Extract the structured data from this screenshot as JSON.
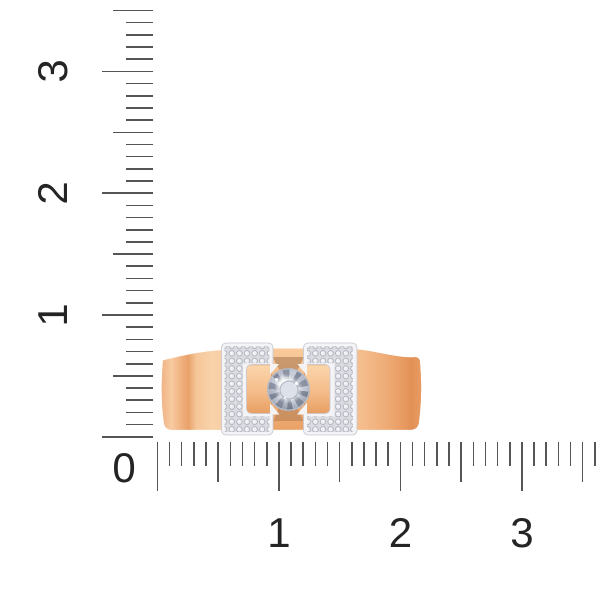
{
  "scene": {
    "background_color": "#FFFFFF",
    "subject": "rose gold ring with diamond center and pave-set white gold brackets on a measurement ruler"
  },
  "rulers": {
    "tick_color": "#555555",
    "label_color": "#242424",
    "vertical": {
      "labels": [
        "1",
        "2",
        "3"
      ],
      "label_values": [
        1,
        2,
        3
      ],
      "origin_label": "0",
      "max_value": 3.5
    },
    "horizontal": {
      "labels": [
        "1",
        "2",
        "3"
      ],
      "label_values": [
        1,
        2,
        3
      ],
      "max_value": 3.6
    }
  },
  "ring": {
    "palette": {
      "band_gradient": [
        [
          "0%",
          "#F0B184"
        ],
        [
          "4%",
          "#F7CBA1"
        ],
        [
          "8%",
          "#F0B07E"
        ],
        [
          "10.5%",
          "#E9A16B"
        ],
        [
          "13.5%",
          "#F5C698"
        ],
        [
          "20%",
          "#F9D3AC"
        ],
        [
          "32%",
          "#F4BC8C"
        ],
        [
          "50%",
          "#F1B17E"
        ],
        [
          "62%",
          "#F3B987"
        ],
        [
          "72%",
          "#F6C595"
        ],
        [
          "82%",
          "#F2B482"
        ],
        [
          "90%",
          "#EBA36B"
        ],
        [
          "96%",
          "#E29156"
        ],
        [
          "100%",
          "#E99C63"
        ]
      ],
      "column_gradient": [
        [
          "0%",
          "#F8CA9B"
        ],
        [
          "50%",
          "#F3B985"
        ],
        [
          "100%",
          "#E9A268"
        ]
      ],
      "bar_gradient": [
        [
          "0%",
          "#FBD7AC"
        ],
        [
          "55%",
          "#F4BC8A"
        ],
        [
          "100%",
          "#E79E61"
        ]
      ],
      "white_metal": "#F4F4F7",
      "white_metal_edge": "#C7C8D1",
      "pave_base": "#DBDCE1",
      "pave_stone": "#EDEFF4",
      "pave_stone_edge": "#A0A3AF",
      "seat_shadow": "#9C6B45",
      "bar_edge": "#D98F52",
      "diamond_light": "#E9ECF2",
      "diamond_mid": "#C7CCD8",
      "diamond_dark": "#848B9B",
      "diamond_table": "#DDE1EA"
    }
  }
}
